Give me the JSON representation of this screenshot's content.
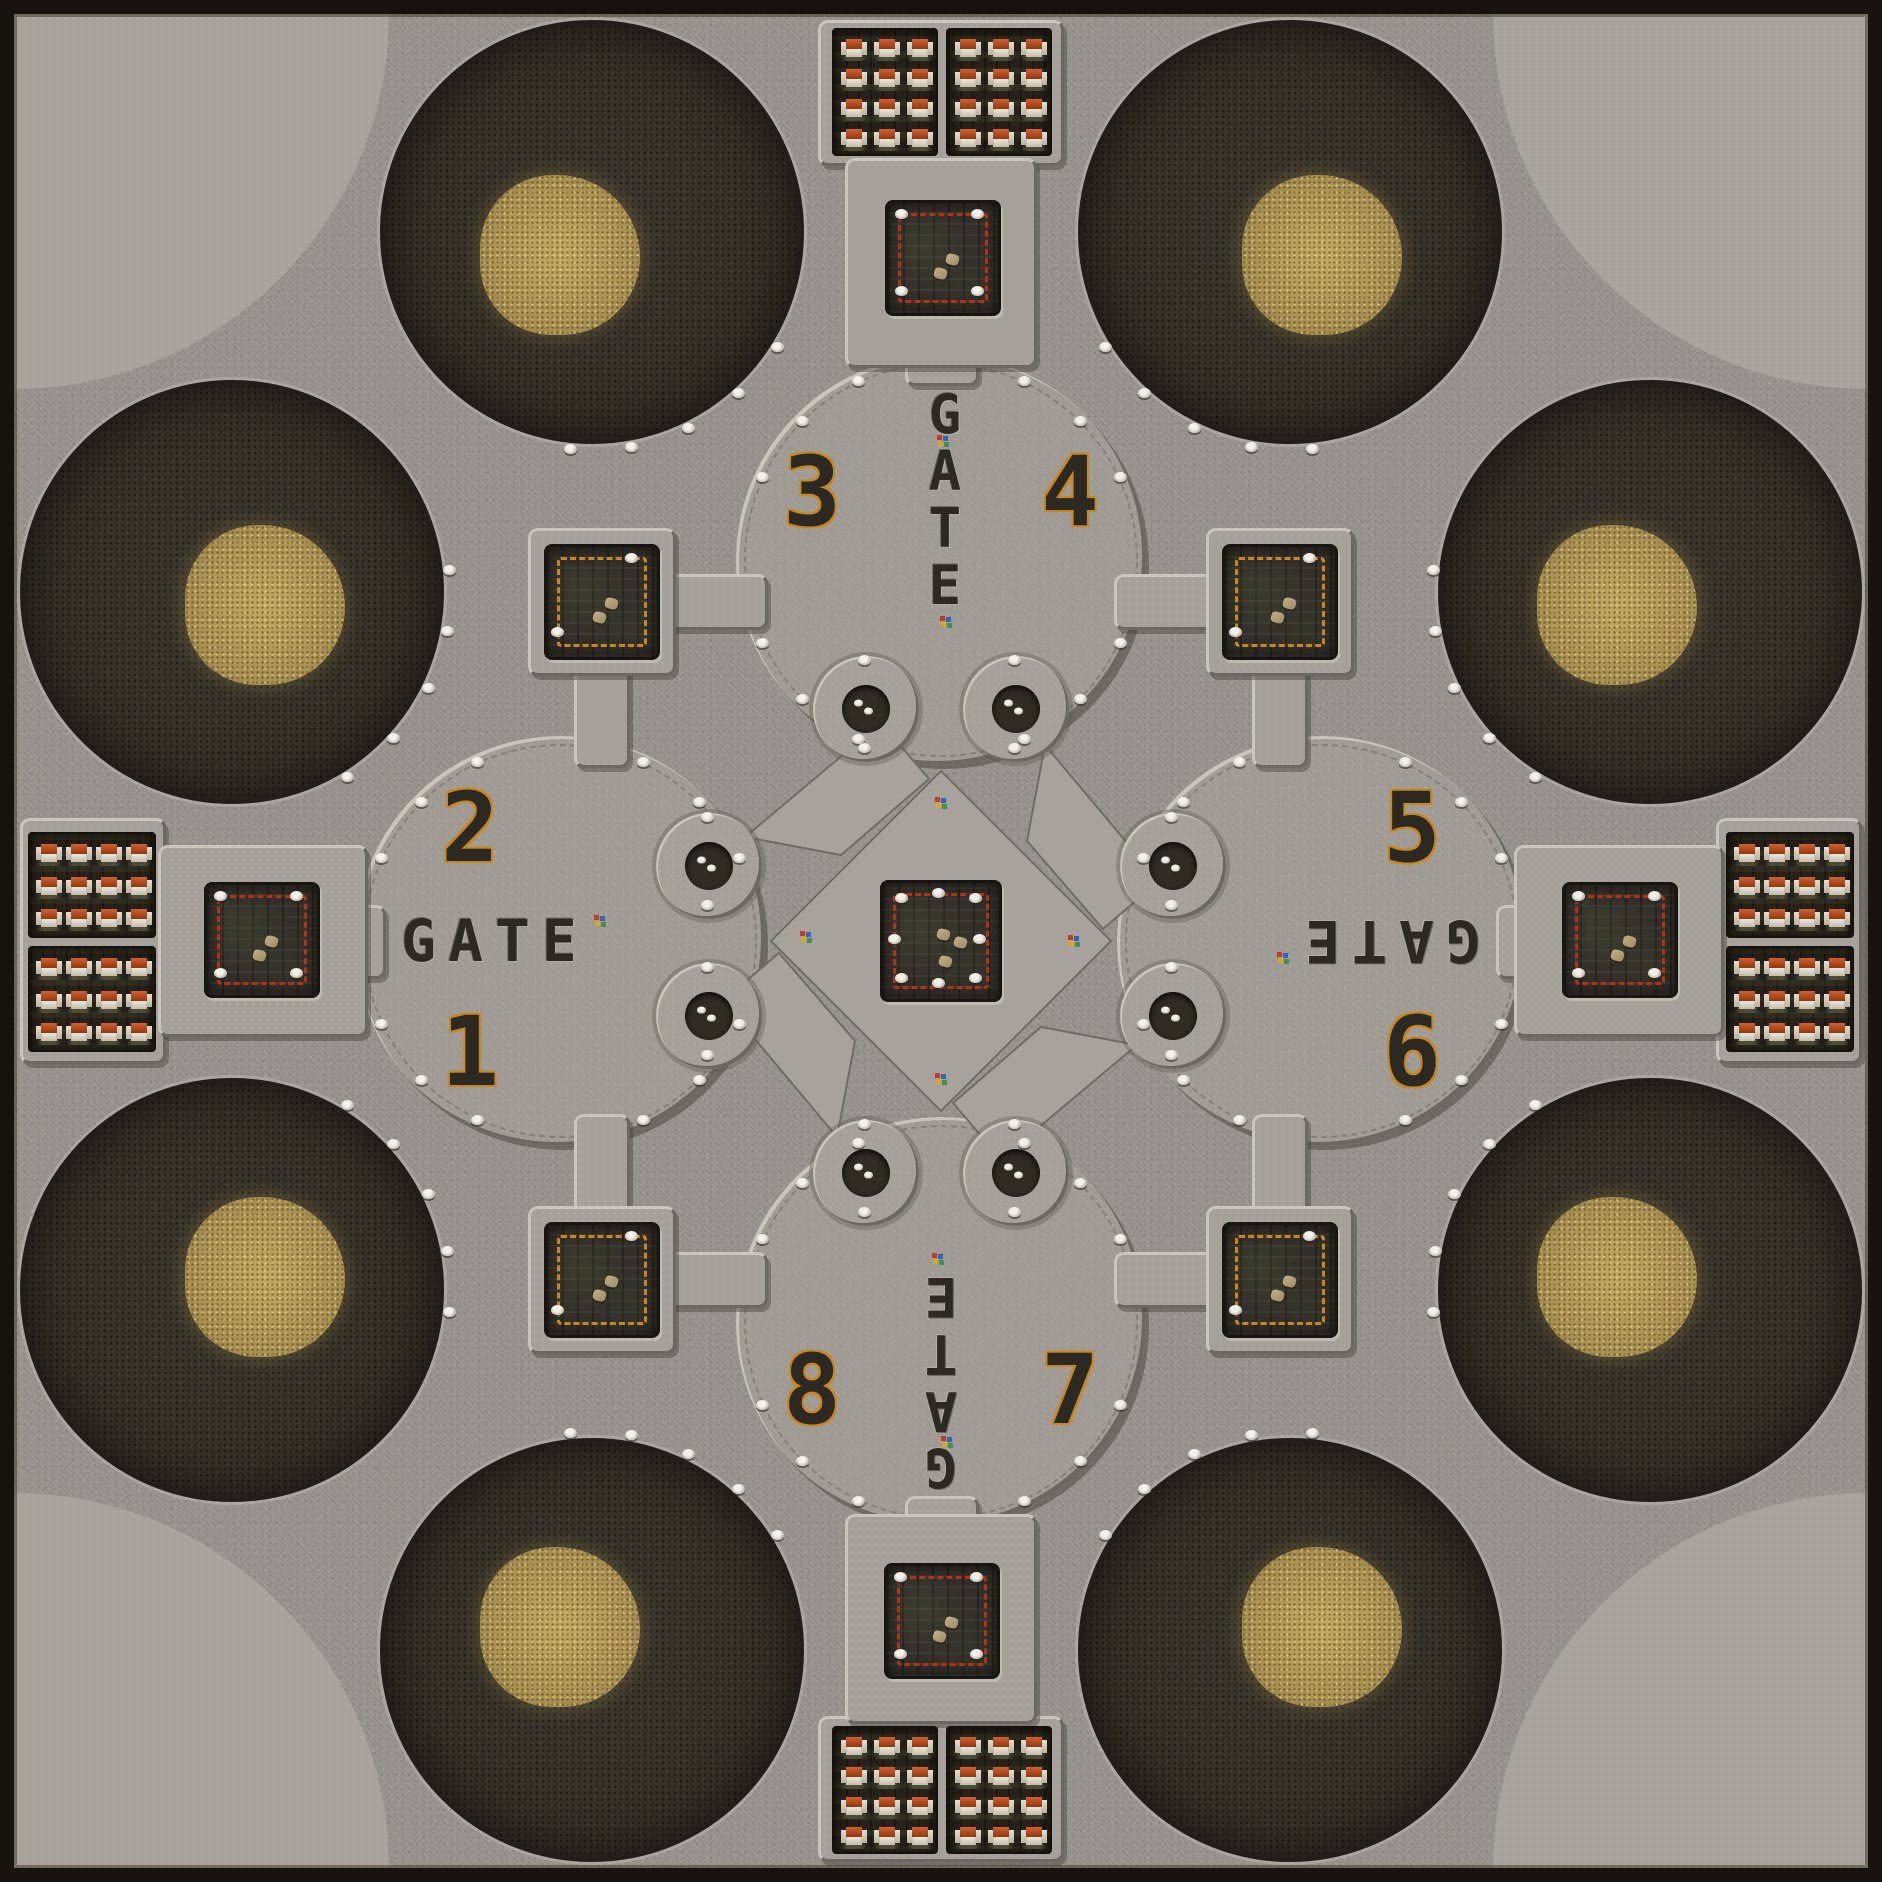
{
  "meta": {
    "title": "GATE arena map",
    "kind": "top-down tile map"
  },
  "colors": {
    "base": "#98948e",
    "corner": "#a8a49d",
    "hub": "#a29e97",
    "plat": "#a5a19a",
    "pin": "#a7a39c",
    "craterEdge": "#211e19",
    "penBg": "#262219",
    "sqBg": "#33302a",
    "red": "#b03217",
    "goldBorder": "#c8871c",
    "text": "#2b2922",
    "frame": "#17130e",
    "castleWall": "#e3ded2",
    "bevelHi": "#c9c5bc",
    "bevelLo": "#6b6862"
  },
  "map": {
    "size": 1882,
    "frame": 14,
    "corner_r": 375,
    "crater_r": 212,
    "gold_r": 80,
    "hub_r": 205,
    "small_r": 53,
    "hole_r": 24
  },
  "corners": [
    {
      "corner": "tl"
    },
    {
      "corner": "tr"
    },
    {
      "corner": "bl"
    },
    {
      "corner": "br"
    }
  ],
  "craters": [
    {
      "x": 592,
      "y": 232,
      "gx": -32,
      "gy": 23
    },
    {
      "x": 1290,
      "y": 232,
      "gx": 32,
      "gy": 23
    },
    {
      "x": 232,
      "y": 592,
      "gx": 33,
      "gy": 13
    },
    {
      "x": 1650,
      "y": 592,
      "gx": -33,
      "gy": 13
    },
    {
      "x": 232,
      "y": 1290,
      "gx": 33,
      "gy": -13
    },
    {
      "x": 1650,
      "y": 1290,
      "gx": -33,
      "gy": -13
    },
    {
      "x": 592,
      "y": 1650,
      "gx": -32,
      "gy": -23
    },
    {
      "x": 1290,
      "y": 1650,
      "gx": 32,
      "gy": -23
    }
  ],
  "hubs": [
    {
      "x": 941,
      "y": 560
    },
    {
      "x": 560,
      "y": 941
    },
    {
      "x": 1322,
      "y": 941
    },
    {
      "x": 941,
      "y": 1322
    }
  ],
  "rim_angles": [
    25,
    45,
    65,
    115,
    135,
    155,
    205,
    225,
    245,
    295,
    315,
    335
  ],
  "crater_arc_offsets": [
    -32,
    -16,
    0,
    16,
    32
  ],
  "platforms": [
    {
      "x": 818,
      "y": 20,
      "w": 246,
      "h": 146
    },
    {
      "x": 845,
      "y": 158,
      "w": 192,
      "h": 210
    },
    {
      "x": 818,
      "y": 1716,
      "w": 246,
      "h": 146
    },
    {
      "x": 845,
      "y": 1514,
      "w": 192,
      "h": 210
    },
    {
      "x": 20,
      "y": 818,
      "w": 146,
      "h": 246
    },
    {
      "x": 158,
      "y": 845,
      "w": 210,
      "h": 192
    },
    {
      "x": 1716,
      "y": 818,
      "w": 146,
      "h": 246
    },
    {
      "x": 1514,
      "y": 845,
      "w": 210,
      "h": 192
    },
    {
      "x": 528,
      "y": 528,
      "w": 148,
      "h": 148
    },
    {
      "x": 1206,
      "y": 528,
      "w": 148,
      "h": 148
    },
    {
      "x": 528,
      "y": 1206,
      "w": 148,
      "h": 148
    },
    {
      "x": 1206,
      "y": 1206,
      "w": 148,
      "h": 148
    }
  ],
  "corridors": [
    {
      "x": 905,
      "y": 340,
      "w": 74,
      "h": 46
    },
    {
      "x": 905,
      "y": 1496,
      "w": 74,
      "h": 46
    },
    {
      "x": 340,
      "y": 905,
      "w": 46,
      "h": 74
    },
    {
      "x": 1496,
      "y": 905,
      "w": 46,
      "h": 74
    },
    {
      "x": 660,
      "y": 574,
      "w": 108,
      "h": 56
    },
    {
      "x": 574,
      "y": 660,
      "w": 56,
      "h": 108
    },
    {
      "x": 1114,
      "y": 574,
      "w": 108,
      "h": 56
    },
    {
      "x": 1252,
      "y": 660,
      "w": 56,
      "h": 108
    },
    {
      "x": 660,
      "y": 1252,
      "w": 108,
      "h": 56
    },
    {
      "x": 574,
      "y": 1114,
      "w": 56,
      "h": 108
    },
    {
      "x": 1114,
      "y": 1252,
      "w": 108,
      "h": 56
    },
    {
      "x": 1252,
      "y": 1114,
      "w": 56,
      "h": 108
    }
  ],
  "pens": [
    {
      "x": 832,
      "y": 28,
      "w": 106,
      "h": 128,
      "cols": 3,
      "rows": 4
    },
    {
      "x": 946,
      "y": 28,
      "w": 106,
      "h": 128,
      "cols": 3,
      "rows": 4
    },
    {
      "x": 832,
      "y": 1726,
      "w": 106,
      "h": 128,
      "cols": 3,
      "rows": 4
    },
    {
      "x": 946,
      "y": 1726,
      "w": 106,
      "h": 128,
      "cols": 3,
      "rows": 4
    },
    {
      "x": 28,
      "y": 832,
      "w": 128,
      "h": 106,
      "cols": 4,
      "rows": 3
    },
    {
      "x": 28,
      "y": 946,
      "w": 128,
      "h": 106,
      "cols": 4,
      "rows": 3
    },
    {
      "x": 1726,
      "y": 832,
      "w": 128,
      "h": 106,
      "cols": 4,
      "rows": 3
    },
    {
      "x": 1726,
      "y": 946,
      "w": 128,
      "h": 106,
      "cols": 4,
      "rows": 3
    }
  ],
  "squares": [
    {
      "id": "center",
      "x": 880,
      "y": 880,
      "size": 122,
      "border": "red",
      "skulls": 8,
      "debris": 3
    },
    {
      "id": "gate-north",
      "x": 885,
      "y": 200,
      "size": 116,
      "border": "red",
      "skulls": 4,
      "debris": 2
    },
    {
      "id": "gate-west",
      "x": 204,
      "y": 882,
      "size": 116,
      "border": "red",
      "skulls": 4,
      "debris": 2
    },
    {
      "id": "gate-east",
      "x": 1562,
      "y": 882,
      "size": 116,
      "border": "red",
      "skulls": 4,
      "debris": 2
    },
    {
      "id": "gate-south",
      "x": 884,
      "y": 1563,
      "size": 116,
      "border": "red",
      "skulls": 4,
      "debris": 2
    },
    {
      "id": "gold-tl",
      "x": 544,
      "y": 544,
      "size": 116,
      "border": "gold",
      "skulls": 2,
      "debris": 2
    },
    {
      "id": "gold-tr",
      "x": 1222,
      "y": 544,
      "size": 116,
      "border": "gold",
      "skulls": 2,
      "debris": 2
    },
    {
      "id": "gold-bl",
      "x": 544,
      "y": 1222,
      "size": 116,
      "border": "gold",
      "skulls": 2,
      "debris": 2
    },
    {
      "id": "gold-br",
      "x": 1222,
      "y": 1222,
      "size": 116,
      "border": "gold",
      "skulls": 2,
      "debris": 2
    }
  ],
  "small_circles": [
    {
      "x": 866,
      "y": 709
    },
    {
      "x": 1016,
      "y": 709
    },
    {
      "x": 709,
      "y": 866
    },
    {
      "x": 709,
      "y": 1016
    },
    {
      "x": 1173,
      "y": 866
    },
    {
      "x": 1173,
      "y": 1016
    },
    {
      "x": 866,
      "y": 1173
    },
    {
      "x": 1016,
      "y": 1173
    }
  ],
  "gates": [
    {
      "id": "north",
      "text": "GATE",
      "x": 945,
      "y": 500,
      "vertical": true,
      "rotated": false
    },
    {
      "id": "south",
      "text": "GATE",
      "x": 941,
      "y": 1382,
      "vertical": true,
      "rotated": true
    },
    {
      "id": "west",
      "text": "GATE",
      "x": 495,
      "y": 941,
      "vertical": false,
      "rotated": false
    },
    {
      "id": "east",
      "text": "GATE",
      "x": 1387,
      "y": 941,
      "vertical": false,
      "rotated": true
    }
  ],
  "numbers": [
    {
      "label": "1",
      "x": 470,
      "y": 1052
    },
    {
      "label": "2",
      "x": 470,
      "y": 828
    },
    {
      "label": "3",
      "x": 812,
      "y": 492
    },
    {
      "label": "4",
      "x": 1070,
      "y": 492
    },
    {
      "label": "5",
      "x": 1412,
      "y": 828
    },
    {
      "label": "6",
      "x": 1412,
      "y": 1052
    },
    {
      "label": "7",
      "x": 1070,
      "y": 1390
    },
    {
      "label": "8",
      "x": 812,
      "y": 1390
    }
  ],
  "units": [
    {
      "x": 943,
      "y": 441
    },
    {
      "x": 946,
      "y": 622
    },
    {
      "x": 600,
      "y": 921
    },
    {
      "x": 806,
      "y": 937
    },
    {
      "x": 941,
      "y": 803
    },
    {
      "x": 1074,
      "y": 941
    },
    {
      "x": 941,
      "y": 1079
    },
    {
      "x": 1283,
      "y": 958
    },
    {
      "x": 938,
      "y": 1259
    },
    {
      "x": 947,
      "y": 1442
    }
  ]
}
